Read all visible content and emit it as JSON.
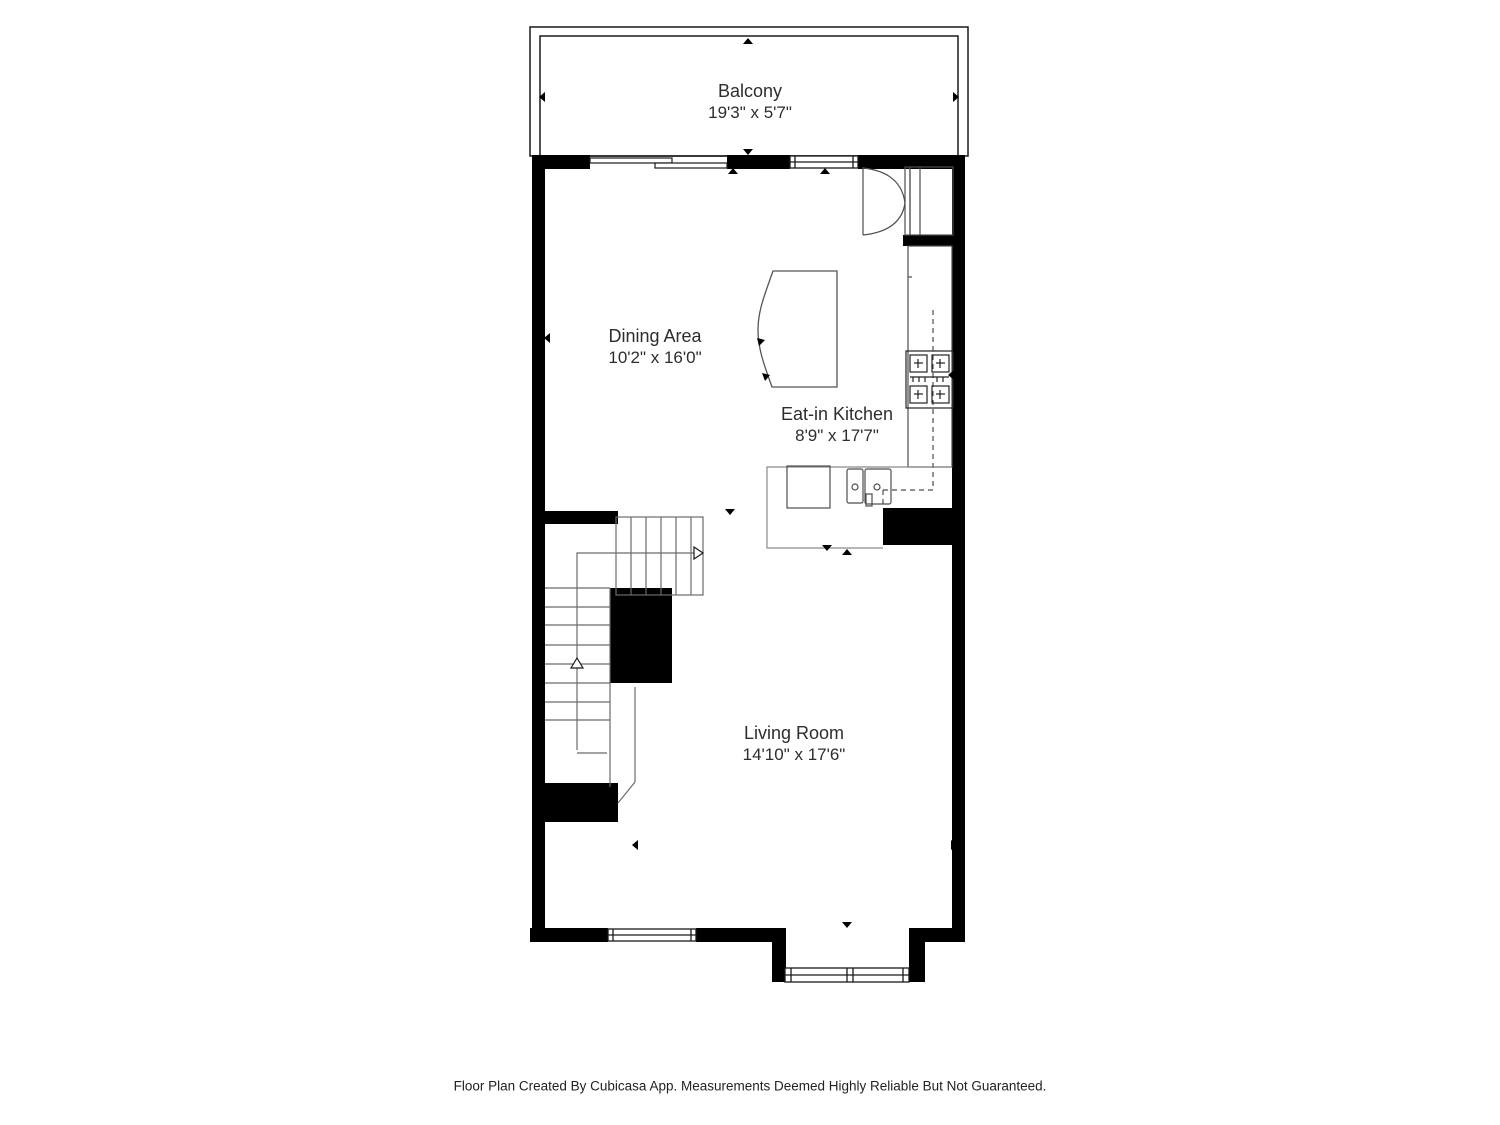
{
  "colors": {
    "wall": "#000000",
    "fixture_line": "#4d4d4d",
    "stair_line": "#6b6b6b",
    "text": "#2d2d2d",
    "background": "#ffffff"
  },
  "rooms": [
    {
      "id": "balcony",
      "name": "Balcony",
      "dimensions": "19'3\" x 5'7\""
    },
    {
      "id": "dining-area",
      "name": "Dining Area",
      "dimensions": "10'2\" x 16'0\""
    },
    {
      "id": "eat-in-kitchen",
      "name": "Eat-in Kitchen",
      "dimensions": "8'9\" x 17'7\""
    },
    {
      "id": "living-room",
      "name": "Living Room",
      "dimensions": "14'10\" x 17'6\""
    }
  ],
  "footer": {
    "text": "Floor Plan Created By Cubicasa App. Measurements Deemed Highly Reliable But Not Guaranteed."
  }
}
